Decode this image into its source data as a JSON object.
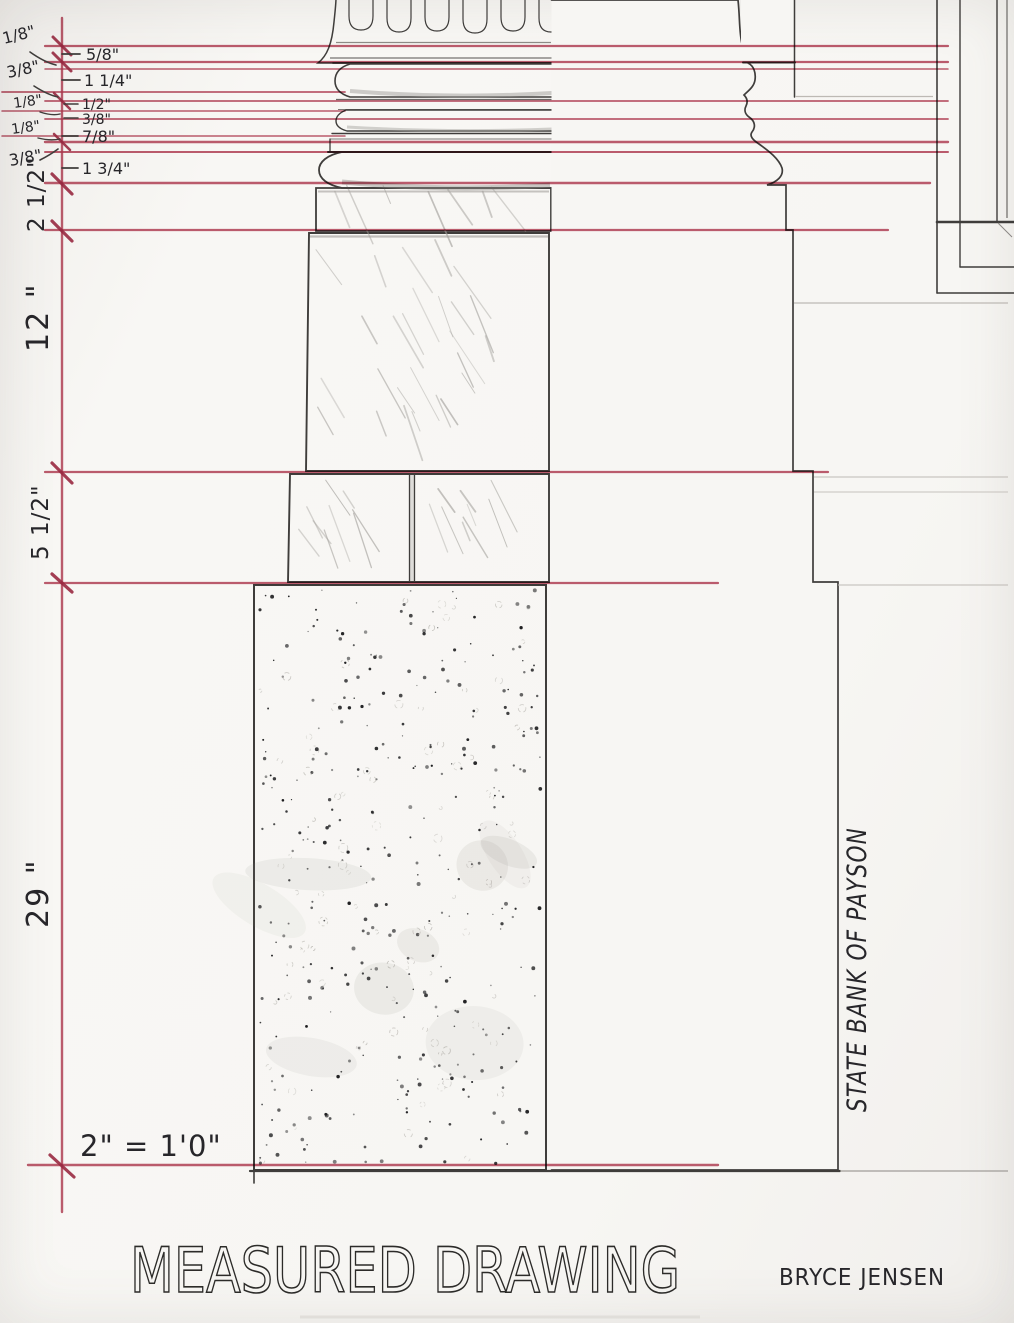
{
  "document": {
    "type_label": "architectural measured drawing",
    "title": "MEASURED DRAWING",
    "author": "BRYCE JENSEN",
    "building_name": "STATE BANK OF PAYSON",
    "scale_note": "2\" = 1'0\""
  },
  "colors": {
    "dimension_red": "#b23a52",
    "tick_red": "#9e2b45",
    "pencil_dark": "#3f3d3b",
    "paper": "#f7f6f3"
  },
  "dimensions": {
    "detail_offsets_left": [
      "1/8\"",
      "3/8\"",
      "1/8\"",
      "1/8\"",
      "3/8\""
    ],
    "molding_heights": [
      "5/8\"",
      "1 1/4\"",
      "1/2\"",
      "3/8\"",
      "7/8\"",
      "1 3/4\""
    ],
    "course_heights": [
      "2 1/2\"",
      "12 \"",
      "5 1/2\"",
      "29 \""
    ]
  }
}
